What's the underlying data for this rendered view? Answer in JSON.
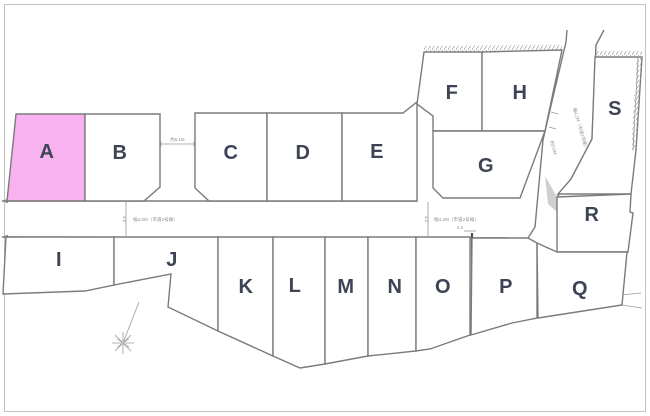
{
  "lots": {
    "a": "A",
    "b": "B",
    "c": "C",
    "d": "D",
    "e": "E",
    "f": "F",
    "g": "G",
    "h": "H",
    "i": "I",
    "j": "J",
    "k": "K",
    "l": "L",
    "m": "M",
    "n": "N",
    "o": "O",
    "p": "P",
    "q": "Q",
    "r": "R",
    "s": "S"
  },
  "selected_lot": "A",
  "annotations": {
    "gap_dimension": "約5.1M",
    "left_road_width": "4.0",
    "left_road_label": "幅4.0M（市道2号線）",
    "right_road_width": "4.2",
    "right_road_label": "幅4.2M（市道2号線）",
    "diagonal_road_label": "幅4.2M（市道1号線）",
    "diagonal_road_width": "約5.0M",
    "vertical_road_width": "4.2"
  },
  "colors": {
    "highlight": "#f8b2f0",
    "outline": "#7b7b7b",
    "label": "#3e4356",
    "annotation": "#8f8f8f",
    "frame": "#c2c2c2",
    "shade": "#cfcfcf"
  }
}
